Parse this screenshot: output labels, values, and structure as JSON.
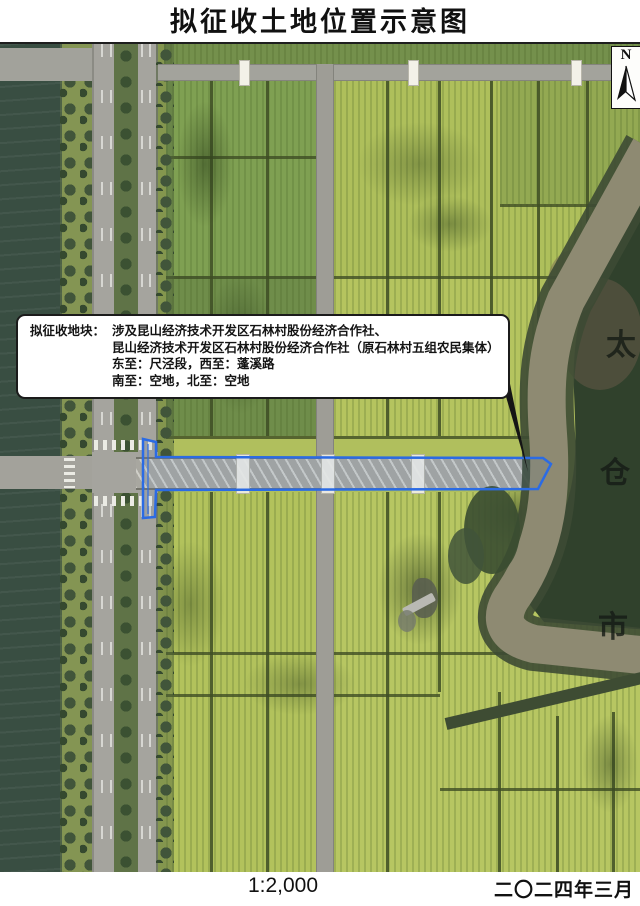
{
  "page": {
    "title": "拟征收土地位置示意图",
    "scale": "1:2,000",
    "date": "二〇二四年三月"
  },
  "map": {
    "north": {
      "label": "N"
    },
    "callout": {
      "label": "拟征收地块：",
      "line1": "涉及昆山经济技术开发区石林村股份经济合作社、",
      "line2": "昆山经济技术开发区石林村股份经济合作社（原石林村五组农民集体）",
      "line3": "东至：尺泾段，西至：蓬溪路",
      "line4": "南至：空地，北至：空地"
    },
    "adjacent_city": {
      "c1": "太",
      "c2": "仓",
      "c3": "市"
    },
    "colors": {
      "parcel_outline": "#2b6be4"
    }
  }
}
